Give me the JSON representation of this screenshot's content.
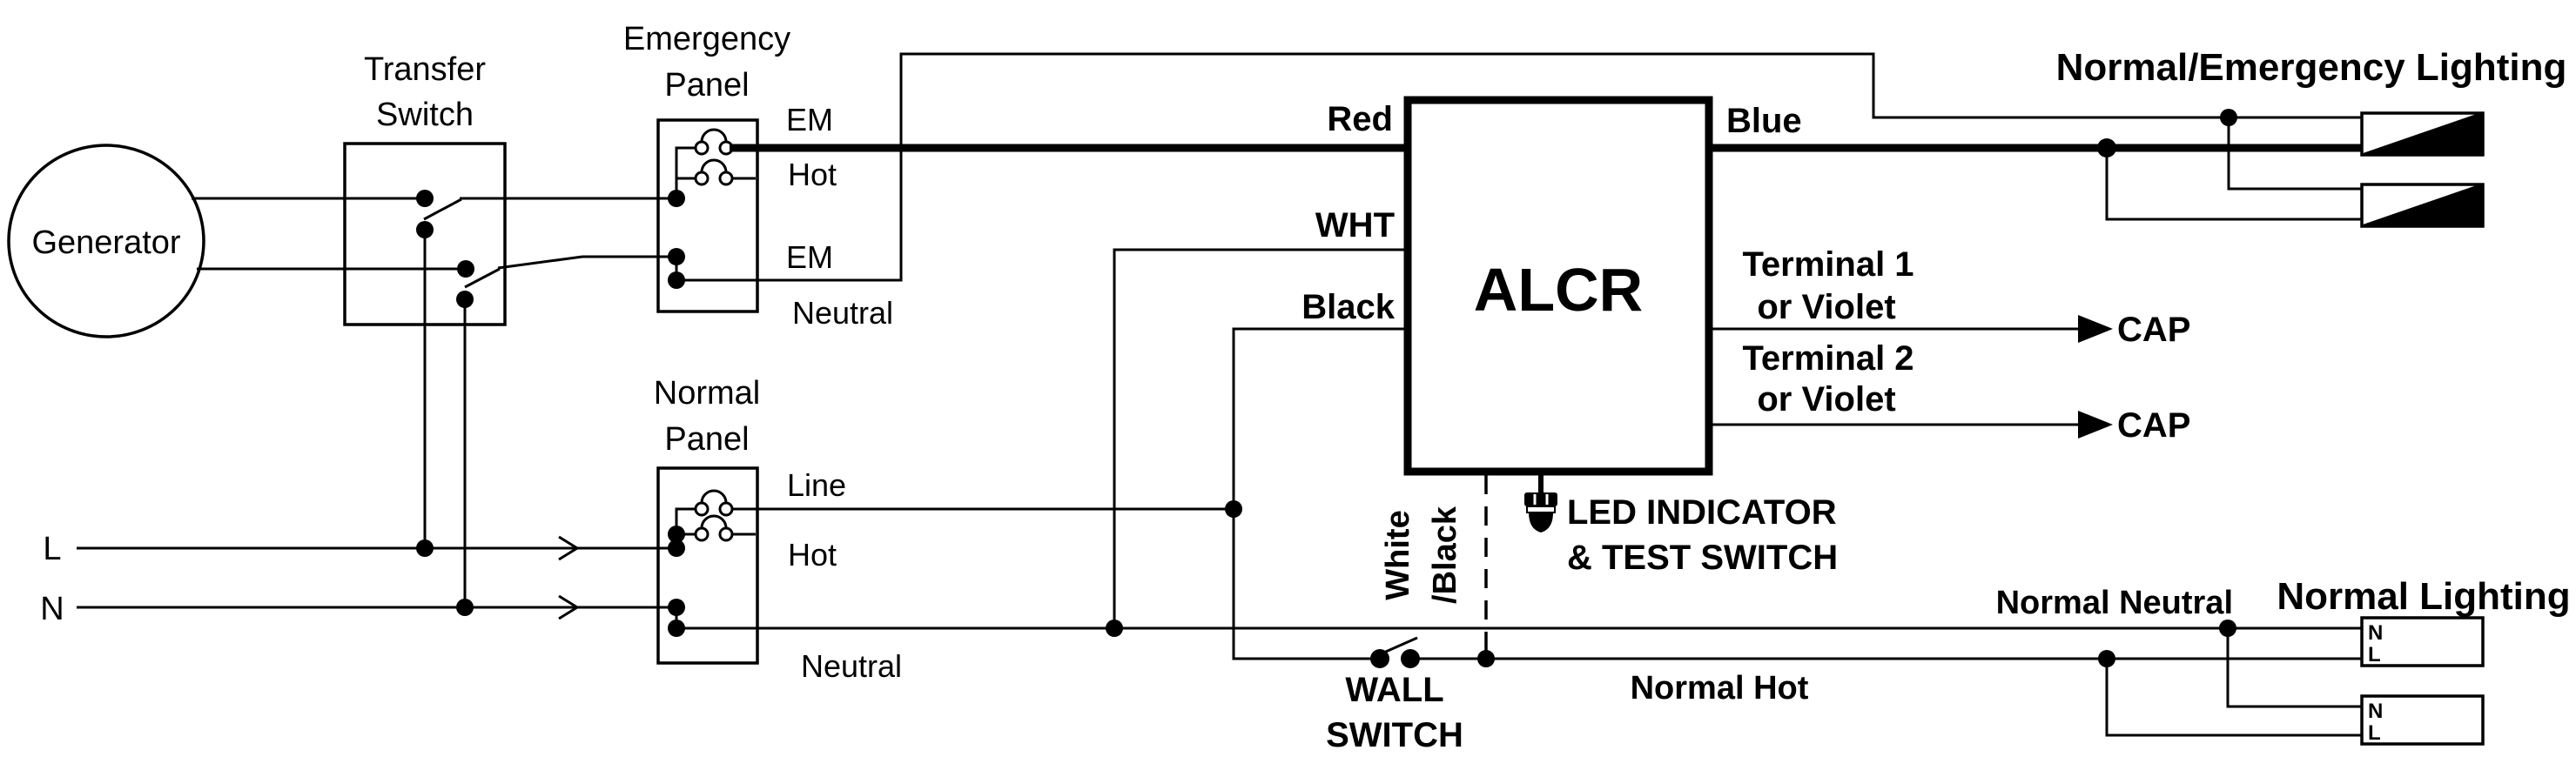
{
  "colors": {
    "line": "#000000",
    "background": "#ffffff"
  },
  "generator": {
    "label": "Generator"
  },
  "transfer_switch": {
    "line1": "Transfer",
    "line2": "Switch"
  },
  "emergency_panel": {
    "line1": "Emergency",
    "line2": "Panel",
    "hot_top": "EM",
    "hot_bottom": "Hot",
    "neutral_top": "EM",
    "neutral_bottom": "Neutral"
  },
  "normal_panel": {
    "line1": "Normal",
    "line2": "Panel",
    "hot_top": "Line",
    "hot_bottom": "Hot",
    "neutral": "Neutral"
  },
  "supply": {
    "line": "L",
    "neutral": "N"
  },
  "alcr": {
    "name": "ALCR",
    "red": "Red",
    "blue": "Blue",
    "wht": "WHT",
    "black": "Black",
    "terminal1_line1": "Terminal 1",
    "terminal1_line2": "or Violet",
    "terminal2_line1": "Terminal 2",
    "terminal2_line2": "or Violet",
    "cap1": "CAP",
    "cap2": "CAP",
    "led_line1": "LED INDICATOR",
    "led_line2": "& TEST SWITCH"
  },
  "wall_switch": {
    "line1": "WALL",
    "line2": "SWITCH",
    "wire_line1": "White",
    "wire_line2": "/Black"
  },
  "wiring": {
    "normal_hot": "Normal Hot",
    "normal_neutral": "Normal Neutral"
  },
  "lighting": {
    "emergency_title": "Normal/Emergency Lighting",
    "normal_title": "Normal Lighting",
    "n": "N",
    "l": "L"
  }
}
